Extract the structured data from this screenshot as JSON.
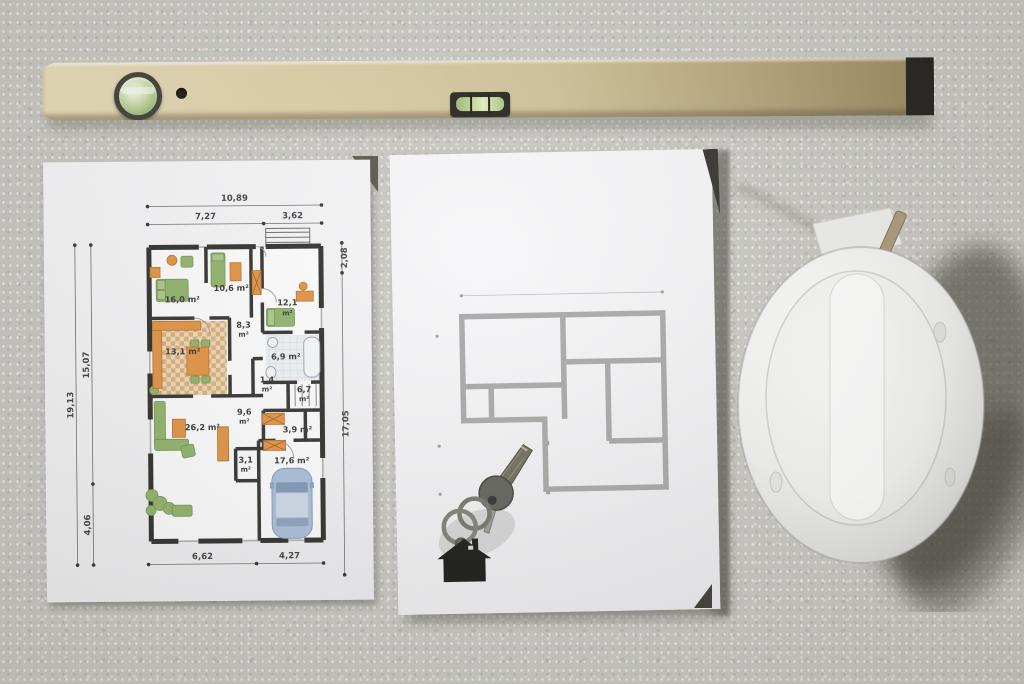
{
  "scene": {
    "description": "top-down photo of construction items on concrete",
    "background_color": "#c8c7c2"
  },
  "objects": {
    "spirit_level": {
      "name": "spirit-level",
      "body_color": "#d8caa0",
      "cap_color": "#1b1a16",
      "vial_color": "#cfe49e"
    },
    "hard_hat": {
      "name": "hard-hat",
      "shell_color": "#f4f4f2",
      "shadow_color": "#514e44"
    },
    "keys": {
      "name": "house-keys",
      "keychain_shape": "house",
      "keychain_color": "#141412",
      "key_color": "#5f5f59"
    }
  },
  "left_plan": {
    "dims": {
      "total_width": "10,89",
      "width_left": "7,27",
      "width_right": "3,62",
      "height_total": "19,13",
      "height_upper": "15,07",
      "height_lower": "4,06",
      "right_upper": "2,08",
      "right_lower": "17,05",
      "bottom_left": "6,62",
      "bottom_right": "4,27"
    },
    "rooms": [
      {
        "label": "16,0 m²"
      },
      {
        "label": "10,6 m²"
      },
      {
        "label": "12,1",
        "unit": "m²"
      },
      {
        "label": "8,3",
        "unit": "m²"
      },
      {
        "label": "13,1 m²"
      },
      {
        "label": "6,9 m²"
      },
      {
        "label": "1,4",
        "unit": "m²"
      },
      {
        "label": "6,7",
        "unit": "m²"
      },
      {
        "label": "9,6",
        "unit": "m²"
      },
      {
        "label": "26,2 m²"
      },
      {
        "label": "3,9 m²"
      },
      {
        "label": "3,1",
        "unit": "m²"
      },
      {
        "label": "17,6 m²"
      }
    ],
    "accent_orange": "#e2913f",
    "accent_green": "#8fb268",
    "car_color": "#a9bedb",
    "wall_color": "#2a2a28"
  },
  "gray_plan": {
    "line_color": "#a6a6a6"
  }
}
